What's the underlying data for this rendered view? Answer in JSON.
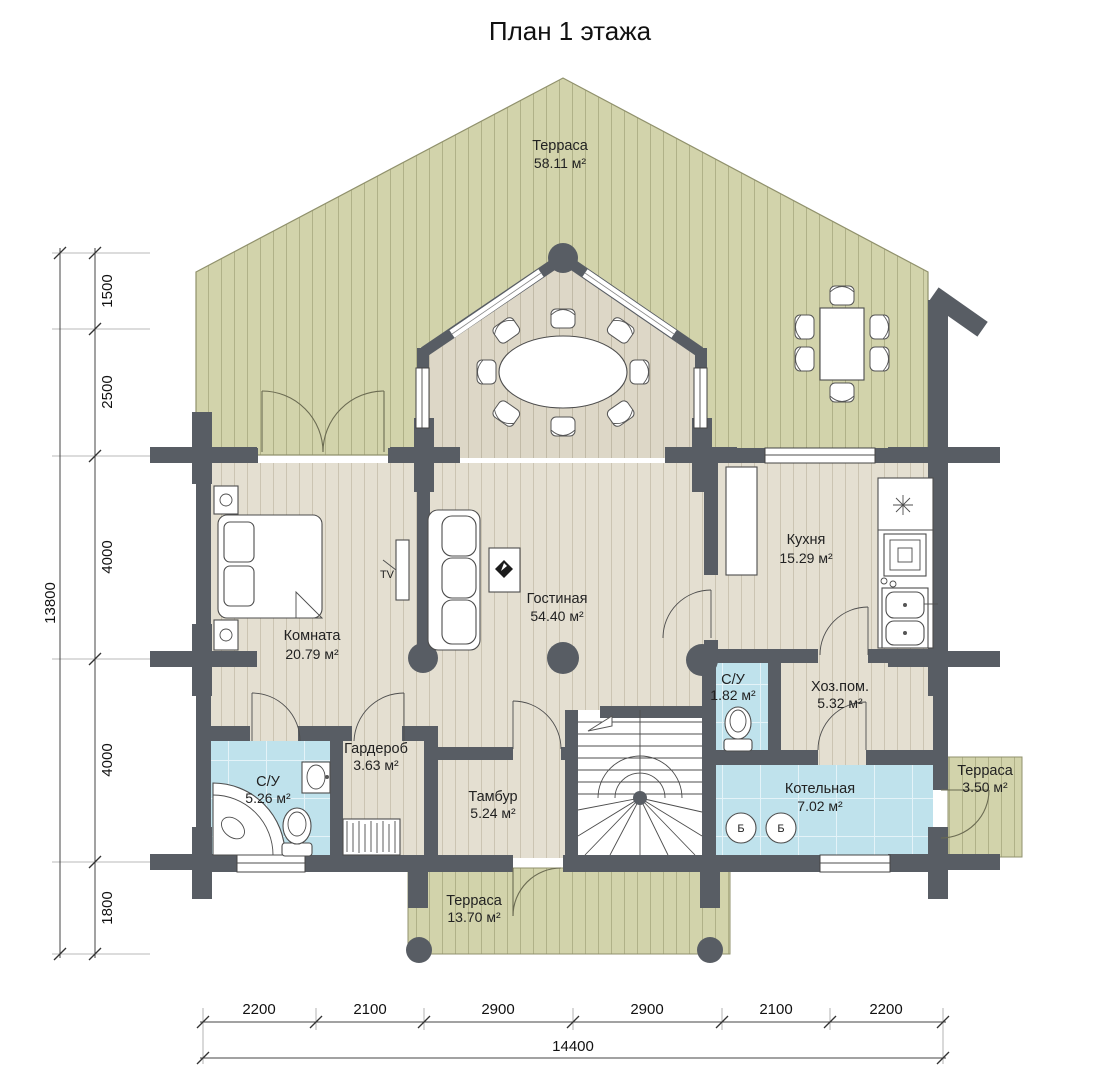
{
  "title": "План 1 этажа",
  "rooms": {
    "terrace_top": {
      "name": "Терраса",
      "area": "58.11 м²"
    },
    "bedroom": {
      "name": "Комната",
      "area": "20.79 м²"
    },
    "living": {
      "name": "Гостиная",
      "area": "54.40 м²"
    },
    "kitchen": {
      "name": "Кухня",
      "area": "15.29 м²"
    },
    "bathroom": {
      "name": "С/У",
      "area": "5.26 м²"
    },
    "wardrobe": {
      "name": "Гардероб",
      "area": "3.63 м²"
    },
    "vestibule": {
      "name": "Тамбур",
      "area": "5.24 м²"
    },
    "wc": {
      "name": "С/У",
      "area": "1.82 м²"
    },
    "utility": {
      "name": "Хоз.пом.",
      "area": "5.32 м²"
    },
    "boiler_room": {
      "name": "Котельная",
      "area": "7.02 м²"
    },
    "terrace_small": {
      "name": "Терраса",
      "area": "3.50 м²"
    },
    "terrace_bottom": {
      "name": "Терраса",
      "area": "13.70 м²"
    }
  },
  "dimensions": {
    "vertical": {
      "total": "13800",
      "segments": [
        "1500",
        "2500",
        "4000",
        "4000",
        "1800"
      ]
    },
    "horizontal": {
      "total": "14400",
      "segments": [
        "2200",
        "2100",
        "2900",
        "2900",
        "2100",
        "2200"
      ]
    }
  },
  "annotations": {
    "tv": "TV",
    "boiler_unit": "Б"
  },
  "colors": {
    "terrace": "#d2d3ab",
    "floor": "#e4dfd1",
    "tile": "#bfe2ec",
    "wall": "#585d64"
  }
}
